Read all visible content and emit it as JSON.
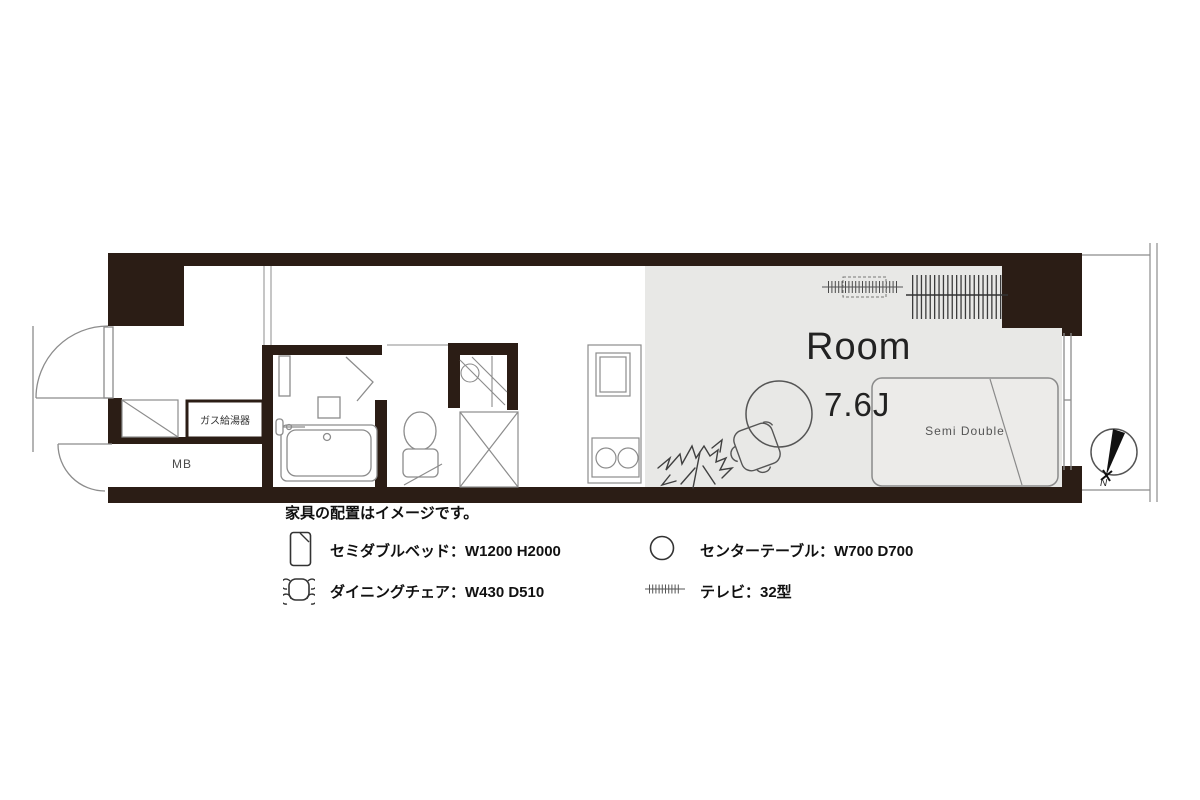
{
  "colors": {
    "wall": "#2b1d15",
    "room_floor": "#e8e8e6",
    "line": "#8c8c8c",
    "dark_line": "#444444"
  },
  "plan": {
    "room_name": "Room",
    "room_size": "7.6J",
    "bed_label": "Semi Double",
    "mb_label": "MB",
    "gas_heater_label": "ガス給湯器",
    "compass_label": "N"
  },
  "legend": {
    "note": "家具の配置はイメージです。",
    "items": [
      {
        "label": "セミダブルベッド：W1200 H2000"
      },
      {
        "label": "ダイニングチェア：W430 D510"
      },
      {
        "label": "センターテーブル：W700 D700"
      },
      {
        "label": "テレビ：32型"
      }
    ]
  }
}
